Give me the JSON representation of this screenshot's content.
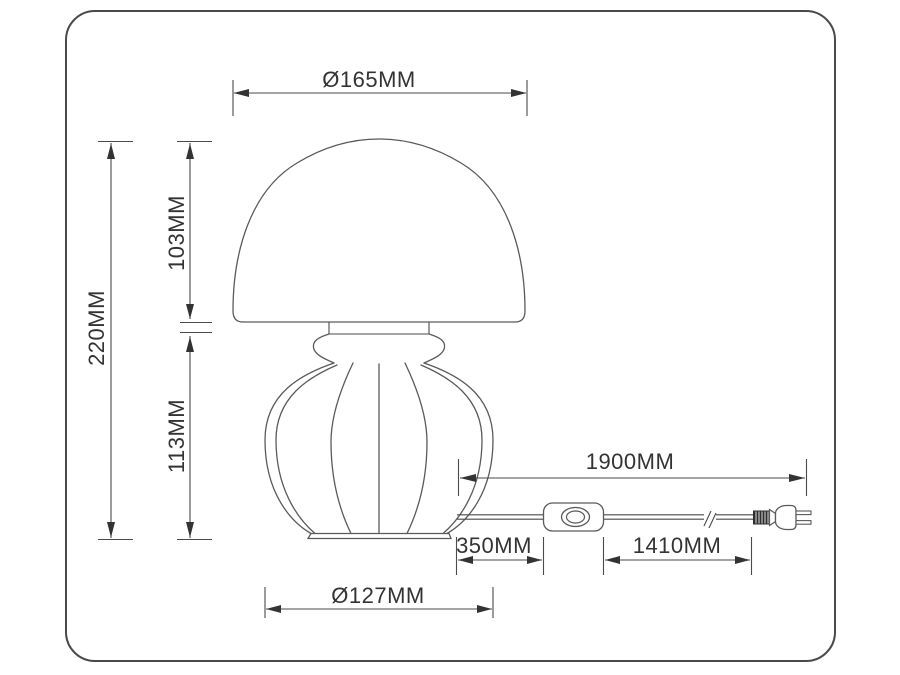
{
  "units": "MM",
  "dimensions": {
    "shade_diameter": {
      "label": "Ø165MM",
      "value": 165
    },
    "total_height": {
      "label": "220MM",
      "value": 220
    },
    "shade_height": {
      "label": "103MM",
      "value": 103
    },
    "base_height": {
      "label": "113MM",
      "value": 113
    },
    "base_diameter": {
      "label": "Ø127MM",
      "value": 127
    },
    "cord_total_length": {
      "label": "1900MM",
      "value": 1900
    },
    "cord_lamp_to_switch": {
      "label": "350MM",
      "value": 350
    },
    "cord_switch_to_plug": {
      "label": "1410MM",
      "value": 1410
    }
  },
  "parts": [
    "lamp-shade",
    "lamp-base",
    "power-cord",
    "inline-switch",
    "power-plug"
  ],
  "colors": {
    "line": "#4a4a4a",
    "text": "#333333",
    "background": "#ffffff"
  }
}
